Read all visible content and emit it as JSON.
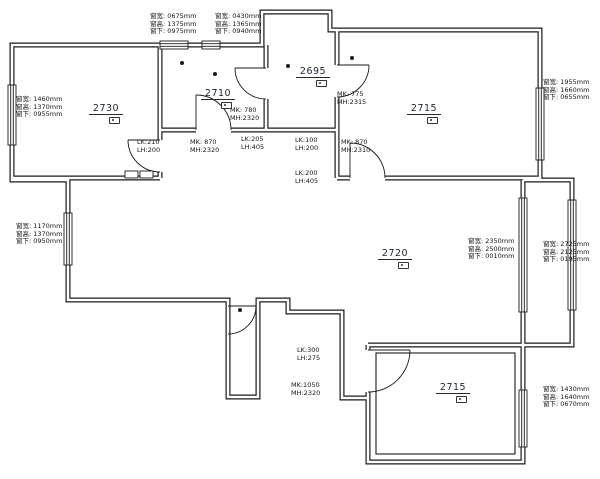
{
  "plan": {
    "title": "apartment-measurement-floor-plan",
    "colors": {
      "wall": "#1a1a1a",
      "background": "#ffffff",
      "text": "#101418"
    },
    "room_height_labels": [
      {
        "id": "room-left-bedroom",
        "value": "2730"
      },
      {
        "id": "room-mid-bedroom",
        "value": "2710"
      },
      {
        "id": "room-top-small",
        "value": "2695"
      },
      {
        "id": "room-right-bedroom",
        "value": "2715"
      },
      {
        "id": "room-living",
        "value": "2720"
      },
      {
        "id": "room-bottom-balcony",
        "value": "2715"
      }
    ],
    "window_labels": [
      {
        "id": "window-left-upper",
        "lines": [
          "窗宽: 1460mm",
          "窗高: 1370mm",
          "窗下: 0955mm"
        ]
      },
      {
        "id": "window-left-lower",
        "lines": [
          "窗宽: 1170mm",
          "窗高: 1370mm",
          "窗下: 0950mm"
        ]
      },
      {
        "id": "window-top-first",
        "lines": [
          "窗宽: 0675mm",
          "窗高: 1375mm",
          "窗下: 0975mm"
        ]
      },
      {
        "id": "window-top-second",
        "lines": [
          "窗宽: 0430mm",
          "窗高: 1365mm",
          "窗下: 0940mm"
        ]
      },
      {
        "id": "window-right-top",
        "lines": [
          "窗宽: 1955mm",
          "窗高: 1660mm",
          "窗下: 0655mm"
        ]
      },
      {
        "id": "window-living-right",
        "lines": [
          "窗宽: 2350mm",
          "窗高: 2500mm",
          "窗下: 0010mm"
        ]
      },
      {
        "id": "window-balcony-right",
        "lines": [
          "窗宽: 2725mm",
          "窗高: 2125mm",
          "窗下: 0195mm"
        ]
      },
      {
        "id": "window-bottom-right",
        "lines": [
          "窗宽: 1430mm",
          "窗高: 1640mm",
          "窗下: 0670mm"
        ]
      }
    ],
    "door_labels": [
      {
        "id": "door-mid-bedroom",
        "lines": [
          "MK: 780",
          "MH:2320"
        ]
      },
      {
        "id": "door-hall-left",
        "lines": [
          "MK: 870",
          "MH:2320"
        ]
      },
      {
        "id": "door-right-bedroom",
        "lines": [
          "MK: 870",
          "MH:2310"
        ]
      },
      {
        "id": "door-top-small",
        "lines": [
          "MK: 775",
          "MH:2315"
        ]
      },
      {
        "id": "door-bottom-balcony",
        "lines": [
          "MK:1050",
          "MH:2320"
        ]
      }
    ],
    "beam_labels": [
      {
        "id": "beam-hall-left",
        "lines": [
          "LK:210",
          "LH:200"
        ]
      },
      {
        "id": "beam-hall-mid",
        "lines": [
          "LK:205",
          "LH:405"
        ]
      },
      {
        "id": "beam-hall-right",
        "lines": [
          "LK:100",
          "LH:200"
        ]
      },
      {
        "id": "beam-living-top",
        "lines": [
          "LK:200",
          "LH:405"
        ]
      },
      {
        "id": "beam-balcony-door",
        "lines": [
          "LK:300",
          "LH:275"
        ]
      }
    ]
  }
}
